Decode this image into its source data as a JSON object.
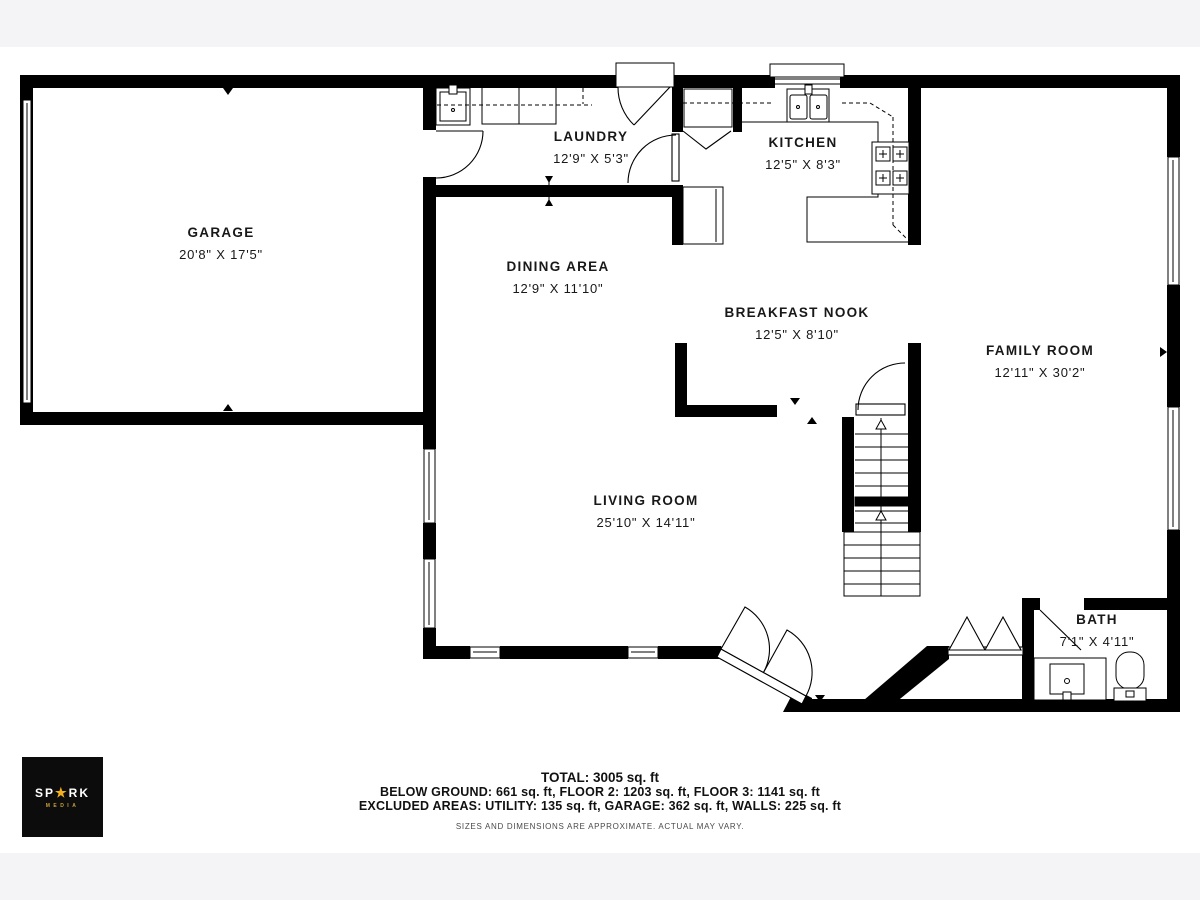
{
  "rooms": {
    "garage": {
      "name": "GARAGE",
      "dims": "20'8\" X 17'5\""
    },
    "laundry": {
      "name": "LAUNDRY",
      "dims": "12'9\" X 5'3\""
    },
    "kitchen": {
      "name": "KITCHEN",
      "dims": "12'5\" X 8'3\""
    },
    "dining": {
      "name": "DINING AREA",
      "dims": "12'9\" X 11'10\""
    },
    "nook": {
      "name": "BREAKFAST NOOK",
      "dims": "12'5\" X 8'10\""
    },
    "family": {
      "name": "FAMILY ROOM",
      "dims": "12'11\" X 30'2\""
    },
    "living": {
      "name": "LIVING ROOM",
      "dims": "25'10\" X 14'11\""
    },
    "bath": {
      "name": "BATH",
      "dims": "7'1\" X 4'11\""
    }
  },
  "footer": {
    "total": "TOTAL: 3005 sq. ft",
    "line1": "BELOW GROUND: 661 sq. ft, FLOOR 2: 1203 sq. ft, FLOOR 3: 1141 sq. ft",
    "line2": "EXCLUDED AREAS: UTILITY: 135 sq. ft, GARAGE: 362 sq. ft, WALLS: 225 sq. ft",
    "disclaimer": "SIZES AND DIMENSIONS ARE APPROXIMATE. ACTUAL MAY VARY."
  },
  "logo": {
    "prefix": "SP",
    "star": "★",
    "suffix": "RK",
    "subtitle": "MEDIA"
  },
  "colors": {
    "wall": "#000000",
    "page_background": "#f4f4f6",
    "plan_background": "#ffffff",
    "logo_background": "#0c0c0c",
    "logo_gold": "#f2b01e"
  }
}
